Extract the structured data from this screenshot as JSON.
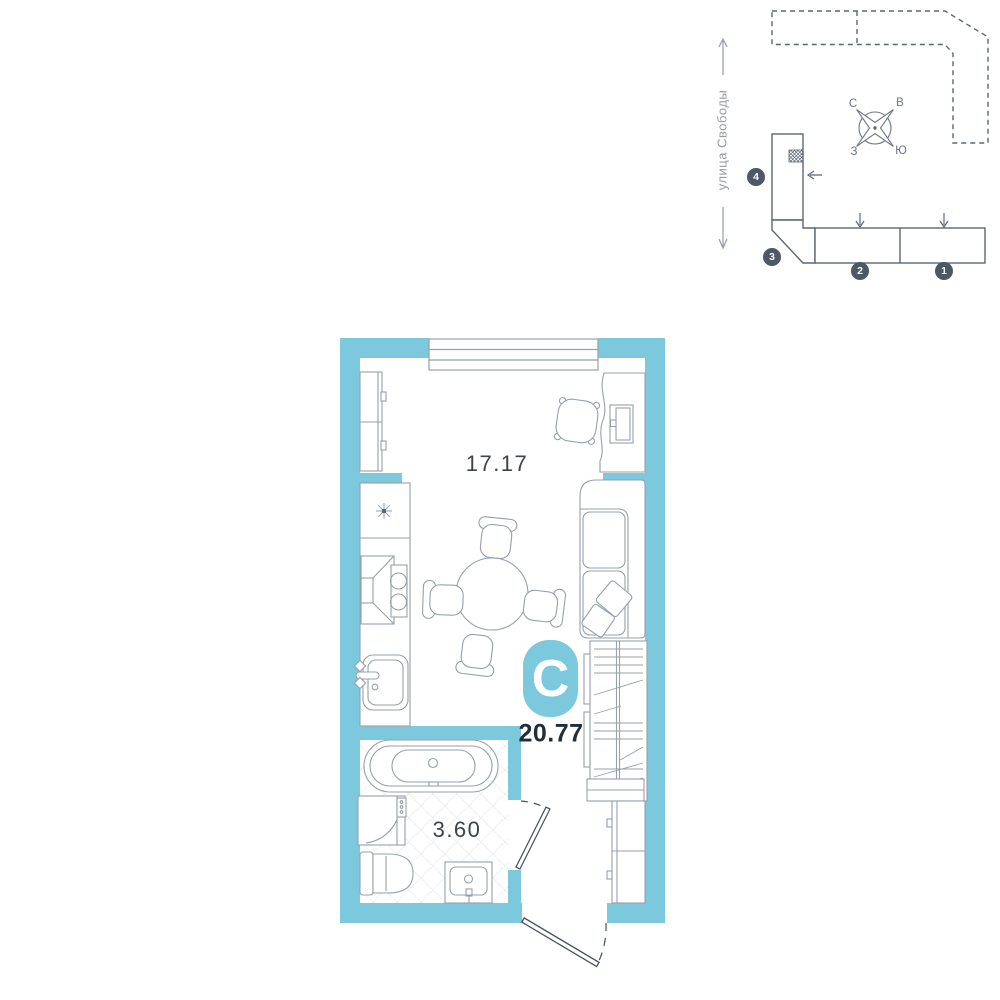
{
  "floor_plan": {
    "room_area": "17.17",
    "bathroom_area": "3.60",
    "total_area": "20.77",
    "type_badge": "С"
  },
  "site_plan": {
    "street": "улица Свободы",
    "compass": {
      "n": "С",
      "e": "В",
      "w": "З",
      "s": "Ю"
    },
    "sections": [
      {
        "number": "1"
      },
      {
        "number": "2"
      },
      {
        "number": "3"
      },
      {
        "number": "4"
      }
    ]
  },
  "icons": {
    "vent": "asterisk-vent-symbol",
    "apartment_marker": "crosshatch-marker",
    "arrows": [
      "street-arrow-up",
      "street-arrow-down",
      "entrance-arrow-down",
      "entrance-arrow-down",
      "entrance-arrow-left"
    ]
  },
  "colors": {
    "wall_teal": "#7cc9dd",
    "badge_teal": "#7cc9de",
    "furniture_line": "#95a0ab",
    "door_line": "#44505e",
    "site_line": "#5c6774",
    "area_text": "#3d444b",
    "total_text": "#242e38",
    "section_badge_bg": "#4d5866",
    "street_text": "#959ca6",
    "tile_line": "#dfe3e6"
  }
}
